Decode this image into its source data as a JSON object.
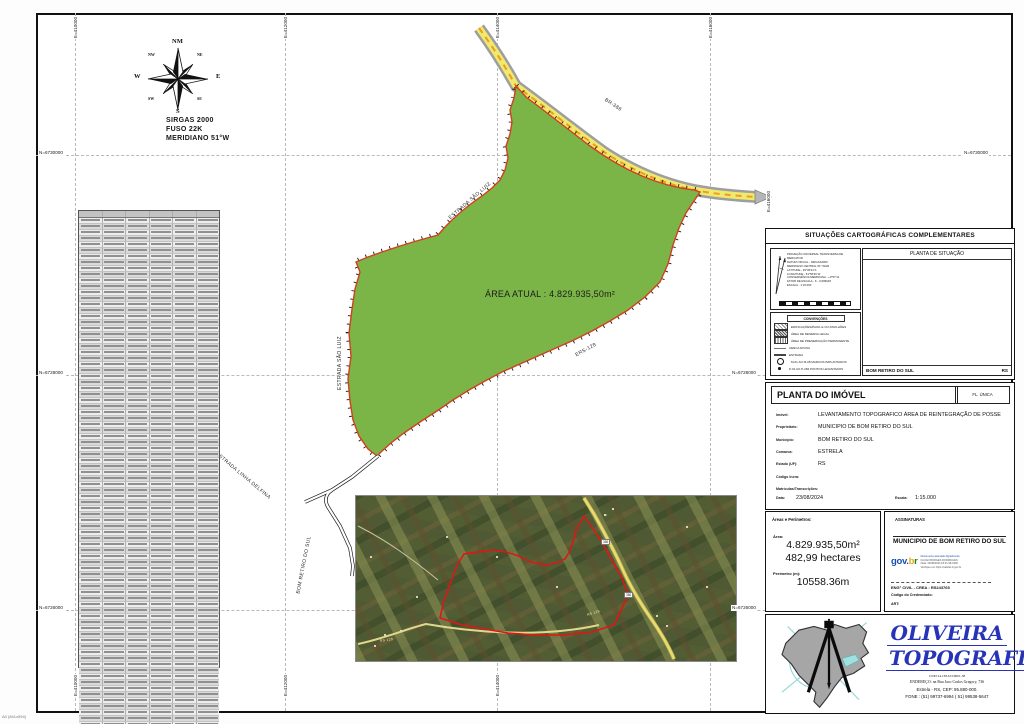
{
  "page": {
    "sheet_label": "A0 (841x594)"
  },
  "compass": {
    "n": "NM",
    "s": "S",
    "e": "E",
    "w": "W",
    "ne": "NE",
    "nw": "NW",
    "se": "SE",
    "sw": "SW"
  },
  "datum": {
    "line1": "SIRGAS 2000",
    "line2": "FUSO 22K",
    "line3": "MERIDIANO 51°W"
  },
  "grid": {
    "top_labels": [
      "E=410000",
      "E=412000",
      "E=414000",
      "E=416000"
    ],
    "bottom_labels": [
      "E=410000",
      "E=412000",
      "E=414000"
    ],
    "left_labels": [
      "N=6730000",
      "N=6728000",
      "N=6726000"
    ],
    "right_labels": [
      "N=6730000",
      "N=6728000",
      "N=6726000"
    ],
    "right_extra": "E=416000"
  },
  "map": {
    "area_label": "ÁREA ATUAL : 4.829.935,50m²",
    "labels": [
      {
        "text": "BR-386"
      },
      {
        "text": "ESTRADA SÃO LUIZ"
      },
      {
        "text": "ESTRADA SÃO LUIZ"
      },
      {
        "text": "ERS-128"
      },
      {
        "text": "ESTRADA LINHA DELFINA"
      },
      {
        "text": "BOM RETIRO DO SUL"
      }
    ],
    "colors": {
      "area_fill": "#7bb447",
      "boundary": "#d2401e"
    }
  },
  "coordinate_table": {
    "columns": 6,
    "rows": 90
  },
  "cartographic_box": {
    "title": "SITUAÇÕES CARTOGRÁFICAS COMPLEMENTARES",
    "projection_lines": [
      "PROJEÇÃO UNIVERSAL TRANSVERSA DE MERCATOR",
      "DATUM OFICIAL - SIRGAS2000",
      "MERIDIANO CENTRAL 51° WGR",
      "LATITUDE - 29°36'44 S",
      "LONGITUDE - 51°55'46 W",
      "CONVERGÊNCIA MERIDIANA - +0°57'41",
      "FATOR DE ESCALA - K - 0,999618",
      "ESCALA - 1:15.000"
    ],
    "conventions_title": "CONVENÇÕES",
    "conventions": [
      {
        "symbol": "building",
        "label": "EDIFICAÇÕES/PAIOL E OU PAVILHÕES"
      },
      {
        "symbol": "reserve",
        "label": "ÁREA DE RESERVA LEGAL"
      },
      {
        "symbol": "app",
        "label": "ÁREA DE PRESERVAÇÃO PERMANENTE"
      },
      {
        "symbol": "fence",
        "label": "CERCA DIVISA"
      },
      {
        "symbol": "road",
        "label": "ESTRADA"
      },
      {
        "symbol": "marker",
        "label": "M-01 AO M-08  MARCOS IMPLANTADOS"
      },
      {
        "symbol": "point",
        "label": "P-01 AO P-284  PONTOS LEVANTADOS"
      }
    ],
    "situation_title": "PLANTA DE SITUAÇÃO",
    "situation_footer_left": "BOM RETIRO DO SUL",
    "situation_footer_right": "RS"
  },
  "property_box": {
    "title": "PLANTA DO IMÓVEL",
    "sheet": "FL. ÚNICA",
    "fields": [
      {
        "label": "Imóvel:",
        "value": "LEVANTAMENTO TOPOGRAFICO ÁREA DE REINTEGRAÇÃO DE POSSE"
      },
      {
        "label": "Proprietário:",
        "value": "MUNICIPIO DE BOM RETIRO DO SUL"
      },
      {
        "label": "Município:",
        "value": "BOM RETIRO DO SUL"
      },
      {
        "label": "Comarca:",
        "value": "ESTRELA"
      },
      {
        "label": "Estado (UF):",
        "value": "RS"
      },
      {
        "label": "Código Incra:",
        "value": ""
      },
      {
        "label": "Matrículas/Transcrições:",
        "value": ""
      }
    ],
    "data_label": "Data:",
    "data_value": "23/08/2024",
    "escala_label": "Escala:",
    "escala_value": "1:15.000"
  },
  "areas_box": {
    "title": "Áreas e Perímetros:",
    "area_label": "Área:",
    "area_m2": "4.829.935,50m²",
    "area_ha": "482,99 hectares",
    "perimeter_label": "Perímetro (m):",
    "perimeter_value": "10558.36m"
  },
  "signatures_box": {
    "title": "ASSINATURAS",
    "signer": "MUNICIPIO DE BOM RETIRO DO SUL",
    "stamp": {
      "brand_gov": "gov",
      "brand_dot": ".",
      "brand_b": "b",
      "brand_r": "r",
      "line1": "Documento assinado digitalmente",
      "line2": "KAUAN BORGES RODRIGUES",
      "line3": "Data: 23/08/2024 18:31:38-0300",
      "line4": "Verifique em https://validar.iti.gov.br"
    },
    "eng_line": "ENG° CIVIL  -  CREA : RS243765",
    "cred_label": "Código do Credenciado:",
    "art_label": "ART:"
  },
  "logo_box": {
    "name_line1": "OLIVEIRA",
    "name_line2": "TOPOGRAFIA",
    "cnpj": "CNPJ 24.138.613/0001-58",
    "address": "ENDEREÇO: na Rua Jaco Carlos Gregory, 736",
    "city": "Estrela - RS,   CEP:  95.880-000.",
    "phone": "FONE : (51) 99737-6994   ( 51) 99538-5647"
  },
  "satellite": {
    "shield_1": "386",
    "shield_2": "386",
    "tag_1": "RS 128",
    "tag_2": "RS 128"
  }
}
